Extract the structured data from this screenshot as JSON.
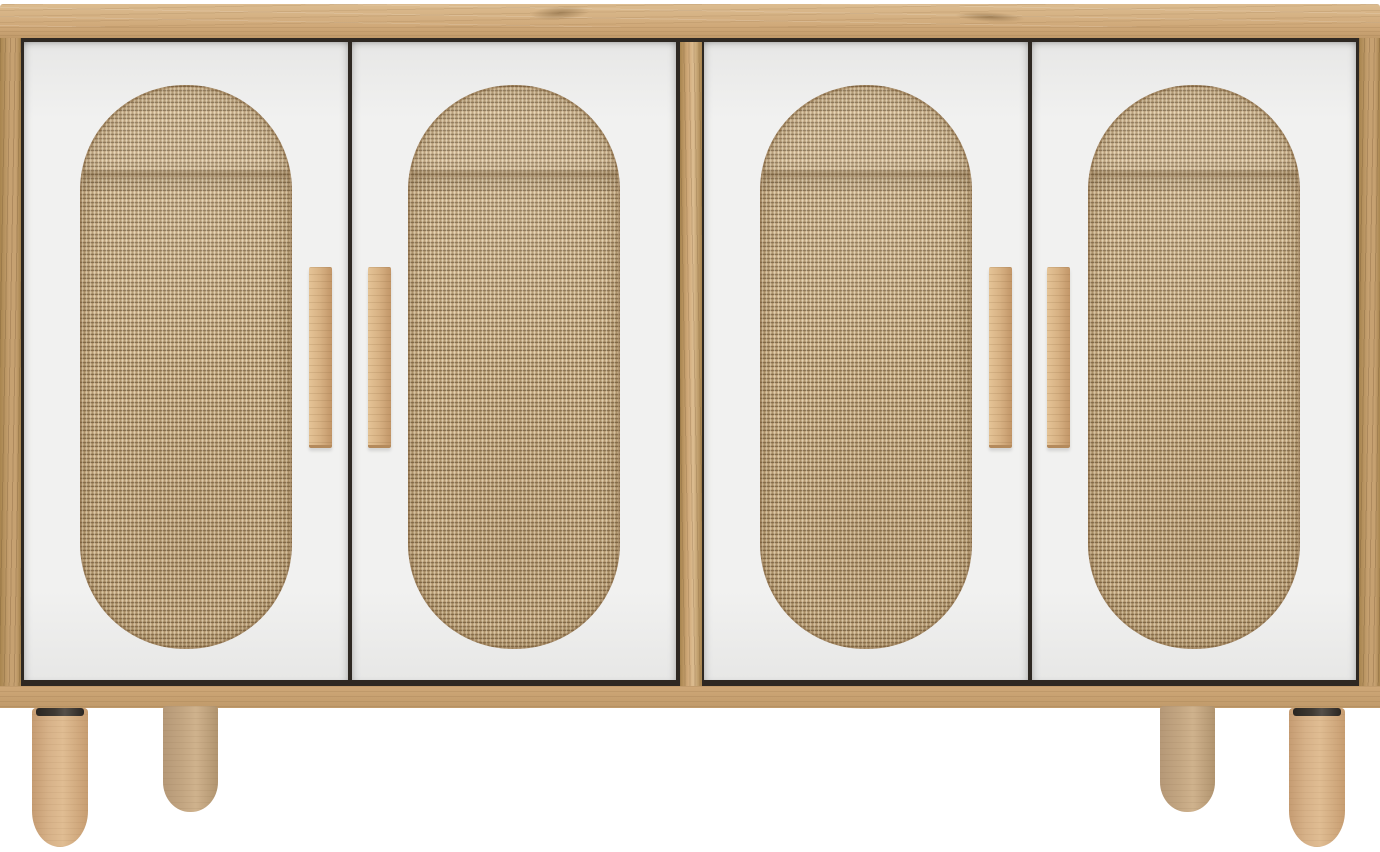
{
  "scene": {
    "type": "product-photo",
    "subject": "sideboard cabinet",
    "description": "Four-door sideboard with light oak frame and top, white door fronts with vertical oval woven jute rattan inserts, paired vertical wooden bar handles, and four round tapered wooden legs, photographed on a plain white background",
    "units": 2,
    "doors": 4,
    "rattan_panels": 4,
    "handles": 4,
    "legs_visible": 4,
    "background": "plain white, no floor shadow"
  },
  "colors": {
    "bg": "#ffffff",
    "wood-top-light": "#dcbc90",
    "wood-top": "#cfa878",
    "wood-edge": "#c09a6a",
    "wood-side": "#c6a171",
    "wood-dark": "#a8854f",
    "seam": "#2e2822",
    "door": "#f1f1f0",
    "door-shade": "#e7e7e6",
    "jute": "#c4a97f",
    "jute-dark": "#7c6443",
    "jute-light": "#e6d2ac",
    "handle": "#d7b183",
    "handle-dark": "#c29668",
    "leg-front": "#d7b289",
    "leg-back": "#c3a682",
    "leg-ring": "#3f3a33"
  },
  "parts": {
    "top_board": "oak top board with horizontal grain",
    "left_panel": "oak left side panel",
    "right_panel": "oak right side panel",
    "center_divider": "oak center divider between door pairs",
    "bottom_rail": "oak bottom rail",
    "door": "white door front with oval jute insert",
    "handle": "vertical oak bar handle",
    "front_leg": "round tapered oak leg with dark mounting ring",
    "back_leg": "round tapered oak leg (rear, partially visible)"
  }
}
